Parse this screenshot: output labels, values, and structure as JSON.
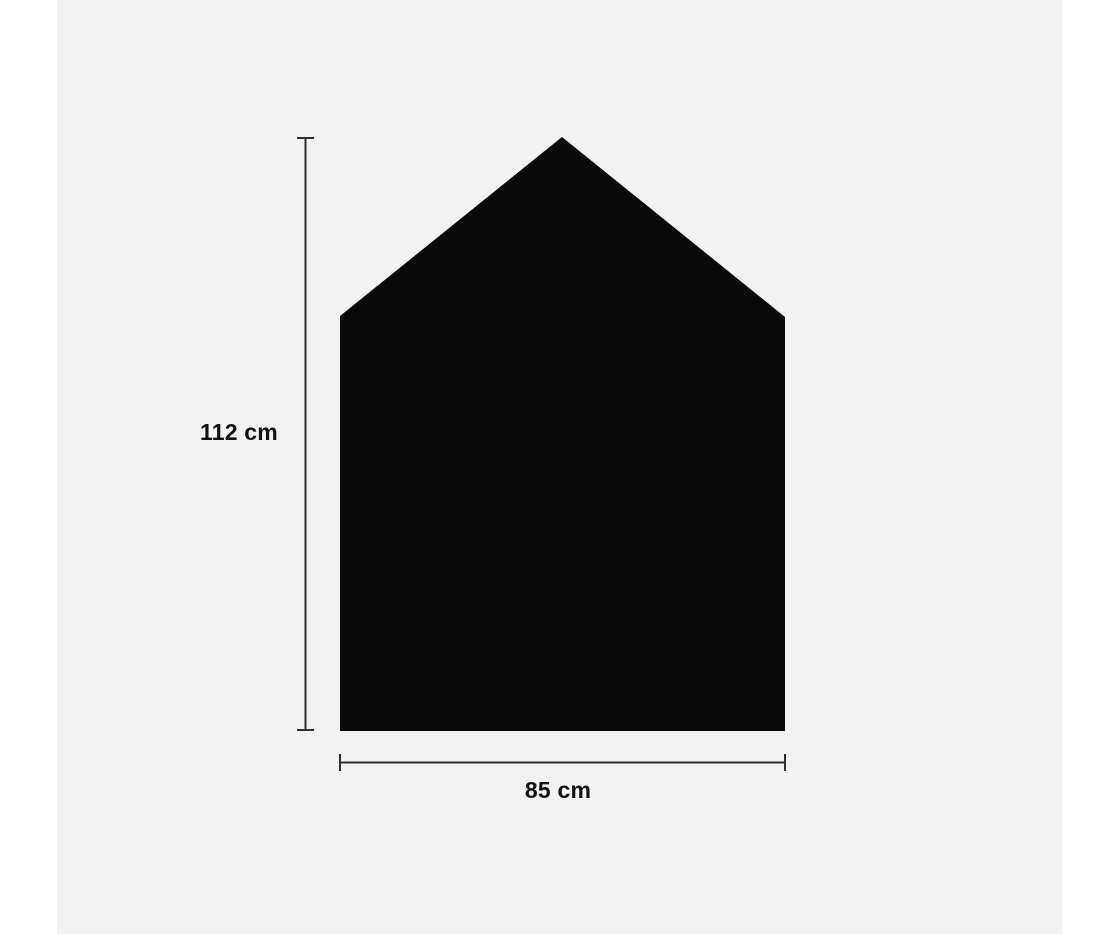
{
  "figure": {
    "type": "dimension-diagram",
    "shape": "house-pentagon-silhouette",
    "height_label": "112 cm",
    "width_label": "85 cm",
    "height_value_cm": 112,
    "width_value_cm": 85
  },
  "colors": {
    "page_background": "#ffffff",
    "canvas_background": "#f2f2f2",
    "shape_fill": "#0a0a0a",
    "dimension_line": "#2e2e2e",
    "label_text": "#111111"
  }
}
